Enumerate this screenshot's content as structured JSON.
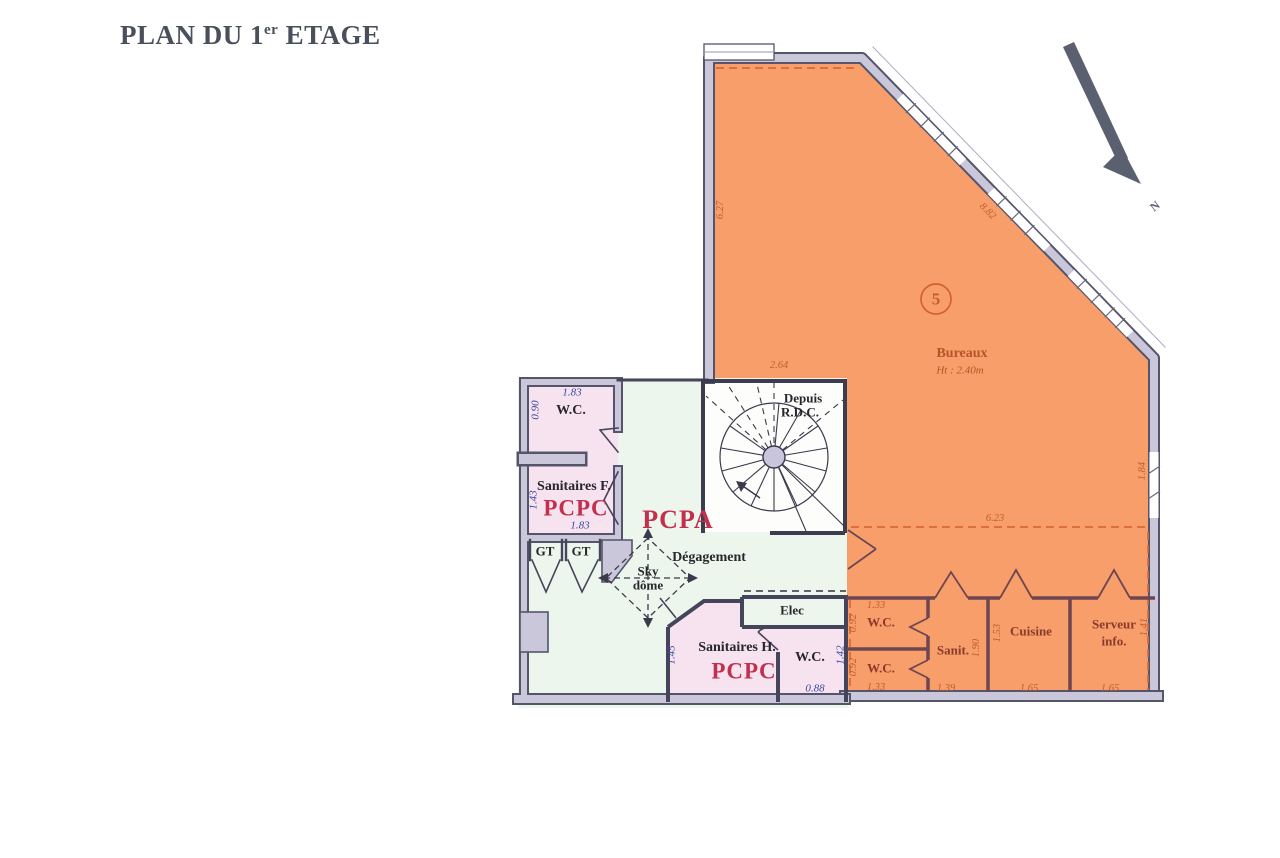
{
  "title": {
    "prefix": "PLAN DU 1",
    "superscript": "er",
    "suffix": " ETAGE"
  },
  "compass": {
    "label": "N"
  },
  "lot": {
    "number": "5",
    "name": "Bureaux",
    "ceiling_height": "Ht : 2.40m"
  },
  "overall_dimensions": {
    "left_wall": "6.27",
    "diagonal_wall": "8.82",
    "stair_notch": "2.64",
    "corridor": "6.23",
    "right_wall": "1.84"
  },
  "rooms": {
    "wc_nw": {
      "name": "W.C.",
      "dim_width": "1.83",
      "dim_depth": "0.90"
    },
    "sanitaires_f": {
      "name": "Sanitaires F.",
      "code": "PCPC",
      "dim_width": "1.83",
      "dim_depth": "1.43"
    },
    "gt_left": {
      "name": "GT"
    },
    "gt_right": {
      "name": "GT"
    },
    "hall": {
      "code": "PCPA",
      "name": "Dégagement"
    },
    "sky_dome": {
      "line1": "Sky",
      "line2": "dôme"
    },
    "stairs": {
      "line1": "Depuis",
      "line2": "R.D.C."
    },
    "elec": {
      "name": "Elec"
    },
    "sanitaires_h": {
      "name": "Sanitaires H.",
      "code": "PCPC",
      "dim_depth": "1.45"
    },
    "wc_mid": {
      "name": "W.C.",
      "dim_width": "0.88",
      "dim_depth": "1.42"
    },
    "wc_top": {
      "name": "W.C.",
      "dim_width": "1.33",
      "dim_depth": "0.92"
    },
    "wc_bottom": {
      "name": "W.C.",
      "dim_width": "1.33",
      "dim_depth": "0.92"
    },
    "sanit": {
      "name": "Sanit.",
      "dim_width": "1.39",
      "dim_depth": "1.90"
    },
    "cuisine": {
      "name": "Cuisine",
      "dim_width": "1.65",
      "dim_depth": "1.53"
    },
    "serveur": {
      "name": "Serveur",
      "name_line2": "info.",
      "dim_width": "1.65",
      "dim_depth": "1.41"
    }
  },
  "colors": {
    "zone_fill": "#f89e6b",
    "pink_fill": "#f6e3ef",
    "green_fill": "#edf6ed",
    "wall_fill": "#cbc7da",
    "wall_line": "#54546a",
    "accent_red": "#c2304e",
    "dim_blue": "#3948a0",
    "dim_orange": "#be5f2e",
    "title_color": "#4a4f5c"
  }
}
